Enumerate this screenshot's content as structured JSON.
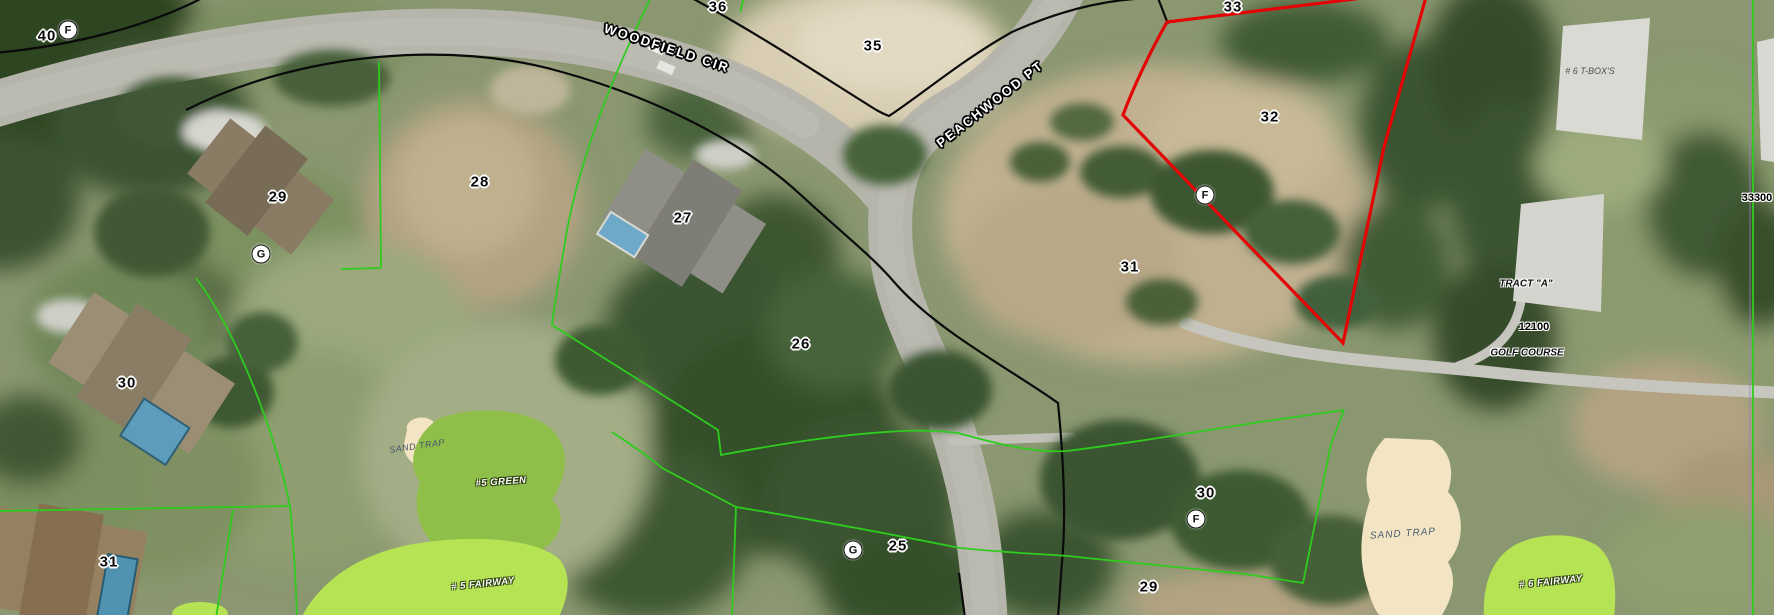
{
  "app": {
    "type": "gis-aerial-parcel-map-view"
  },
  "colors": {
    "parcel-red": "#e30505",
    "lot-line-green": "#2ecc1e",
    "boundary-black": "#0a0a0a",
    "road-gray": "#b6b5ac",
    "sand-trap": "#f3e5c4",
    "fairway-green": "#b6e354",
    "putting-green": "#8fbf49",
    "marker-fill": "#ffffff"
  },
  "map": {
    "streets": [
      {
        "text": "WOODFIELD CIR",
        "x": 667,
        "y": 48,
        "rot": 18,
        "name": "street-label-woodfield-cir"
      },
      {
        "text": "PEACHWOOD PT",
        "x": 990,
        "y": 104,
        "rot": -38,
        "name": "street-label-peachwood-pt"
      }
    ],
    "lot_numbers": [
      {
        "text": "40",
        "x": 47,
        "y": 36
      },
      {
        "text": "36",
        "x": 718,
        "y": 7
      },
      {
        "text": "35",
        "x": 873,
        "y": 46
      },
      {
        "text": "33",
        "x": 1233,
        "y": 7
      },
      {
        "text": "32",
        "x": 1270,
        "y": 117
      },
      {
        "text": "31",
        "x": 1130,
        "y": 267
      },
      {
        "text": "29",
        "x": 278,
        "y": 197
      },
      {
        "text": "28",
        "x": 480,
        "y": 182
      },
      {
        "text": "27",
        "x": 683,
        "y": 218
      },
      {
        "text": "26",
        "x": 801,
        "y": 344
      },
      {
        "text": "25",
        "x": 898,
        "y": 546
      },
      {
        "text": "30",
        "x": 127,
        "y": 383
      },
      {
        "text": "31",
        "x": 109,
        "y": 562
      },
      {
        "text": "30",
        "x": 1206,
        "y": 493
      },
      {
        "text": "29",
        "x": 1149,
        "y": 587
      }
    ],
    "annotations": [
      {
        "text": "33300",
        "x": 1757,
        "y": 198,
        "cls": "ref-number",
        "name": "road-ref-33300"
      },
      {
        "text": "12100",
        "x": 1534,
        "y": 327,
        "cls": "ref-number",
        "name": "road-ref-12100"
      },
      {
        "text": "TRACT \"A\"",
        "x": 1526,
        "y": 284,
        "cls": "tract-label",
        "name": "tract-a-label"
      },
      {
        "text": "GOLF COURSE",
        "x": 1527,
        "y": 353,
        "cls": "golfcourse-label",
        "name": "golf-course-label"
      },
      {
        "text": "# 6 T-BOX'S",
        "x": 1590,
        "y": 71,
        "cls": "tbox-label",
        "name": "tee-box-label"
      }
    ],
    "golf_labels": [
      {
        "text": "SAND TRAP",
        "x": 417,
        "y": 446,
        "rot": -8,
        "cls": "sandtrap-sm",
        "name": "sand-trap-label"
      },
      {
        "text": "SAND TRAP",
        "x": 1403,
        "y": 534,
        "rot": -4,
        "cls": "sandtrap-lg",
        "name": "sand-trap-label"
      },
      {
        "text": "#5 GREEN",
        "x": 501,
        "y": 482,
        "rot": -4,
        "cls": "fairway-label",
        "name": "green-5-label"
      },
      {
        "text": "# 5 FAIRWAY",
        "x": 483,
        "y": 584,
        "rot": -6,
        "cls": "fairway-label",
        "name": "fairway-5-label"
      },
      {
        "text": "# 6 FAIRWAY",
        "x": 1551,
        "y": 582,
        "rot": -6,
        "cls": "fairway-label",
        "name": "fairway-6-label"
      }
    ],
    "markers": [
      {
        "letter": "F",
        "x": 68,
        "y": 30,
        "name": "marker-F"
      },
      {
        "letter": "G",
        "x": 261,
        "y": 254,
        "name": "marker-G"
      },
      {
        "letter": "F",
        "x": 1205,
        "y": 195,
        "name": "marker-F"
      },
      {
        "letter": "G",
        "x": 853,
        "y": 550,
        "name": "marker-G"
      },
      {
        "letter": "F",
        "x": 1196,
        "y": 519,
        "name": "marker-F"
      }
    ]
  }
}
